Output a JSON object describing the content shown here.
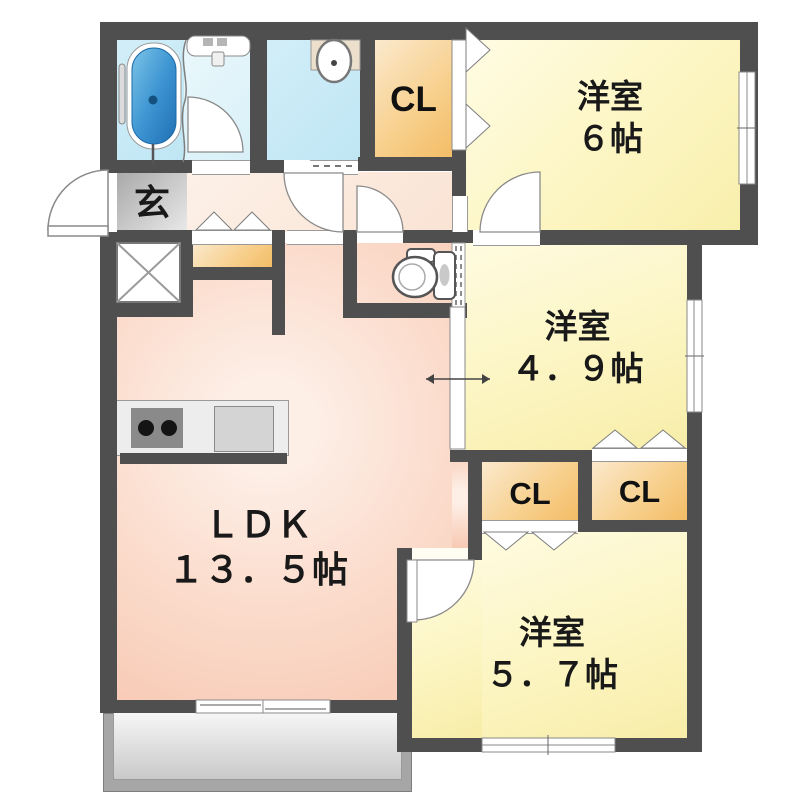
{
  "plan": {
    "type": "apartment-floor-plan",
    "rooms": {
      "western6": {
        "name": "洋室",
        "size": "６帖"
      },
      "western49": {
        "name": "洋室",
        "size": "４．９帖"
      },
      "western57": {
        "name": "洋室",
        "size": "５．７帖"
      },
      "ldk": {
        "name": "ＬＤＫ",
        "size": "１３．５帖"
      },
      "genkan": {
        "label": "玄"
      },
      "closet_north": {
        "label": "CL"
      },
      "closet_mid_left": {
        "label": "CL"
      },
      "closet_mid_right": {
        "label": "CL"
      }
    },
    "fixtures": [
      "bathtub-icon",
      "washbasin-icon",
      "powder-basin-icon",
      "toilet-icon",
      "stove-icon",
      "kitchen-sink-icon"
    ],
    "colors": {
      "wall": "#4f4f4f",
      "room_yellow": "#f8efab",
      "ldk_pink": "#f7c9b4",
      "hall_peach": "#fae3d4",
      "closet_orange": "#f3bd66",
      "water_blue": "#bfe6f4",
      "tub_blue": "#2f86c4",
      "genkan_gray": "#bdbdbd",
      "balcony_gray": "#a6a6a6"
    }
  }
}
